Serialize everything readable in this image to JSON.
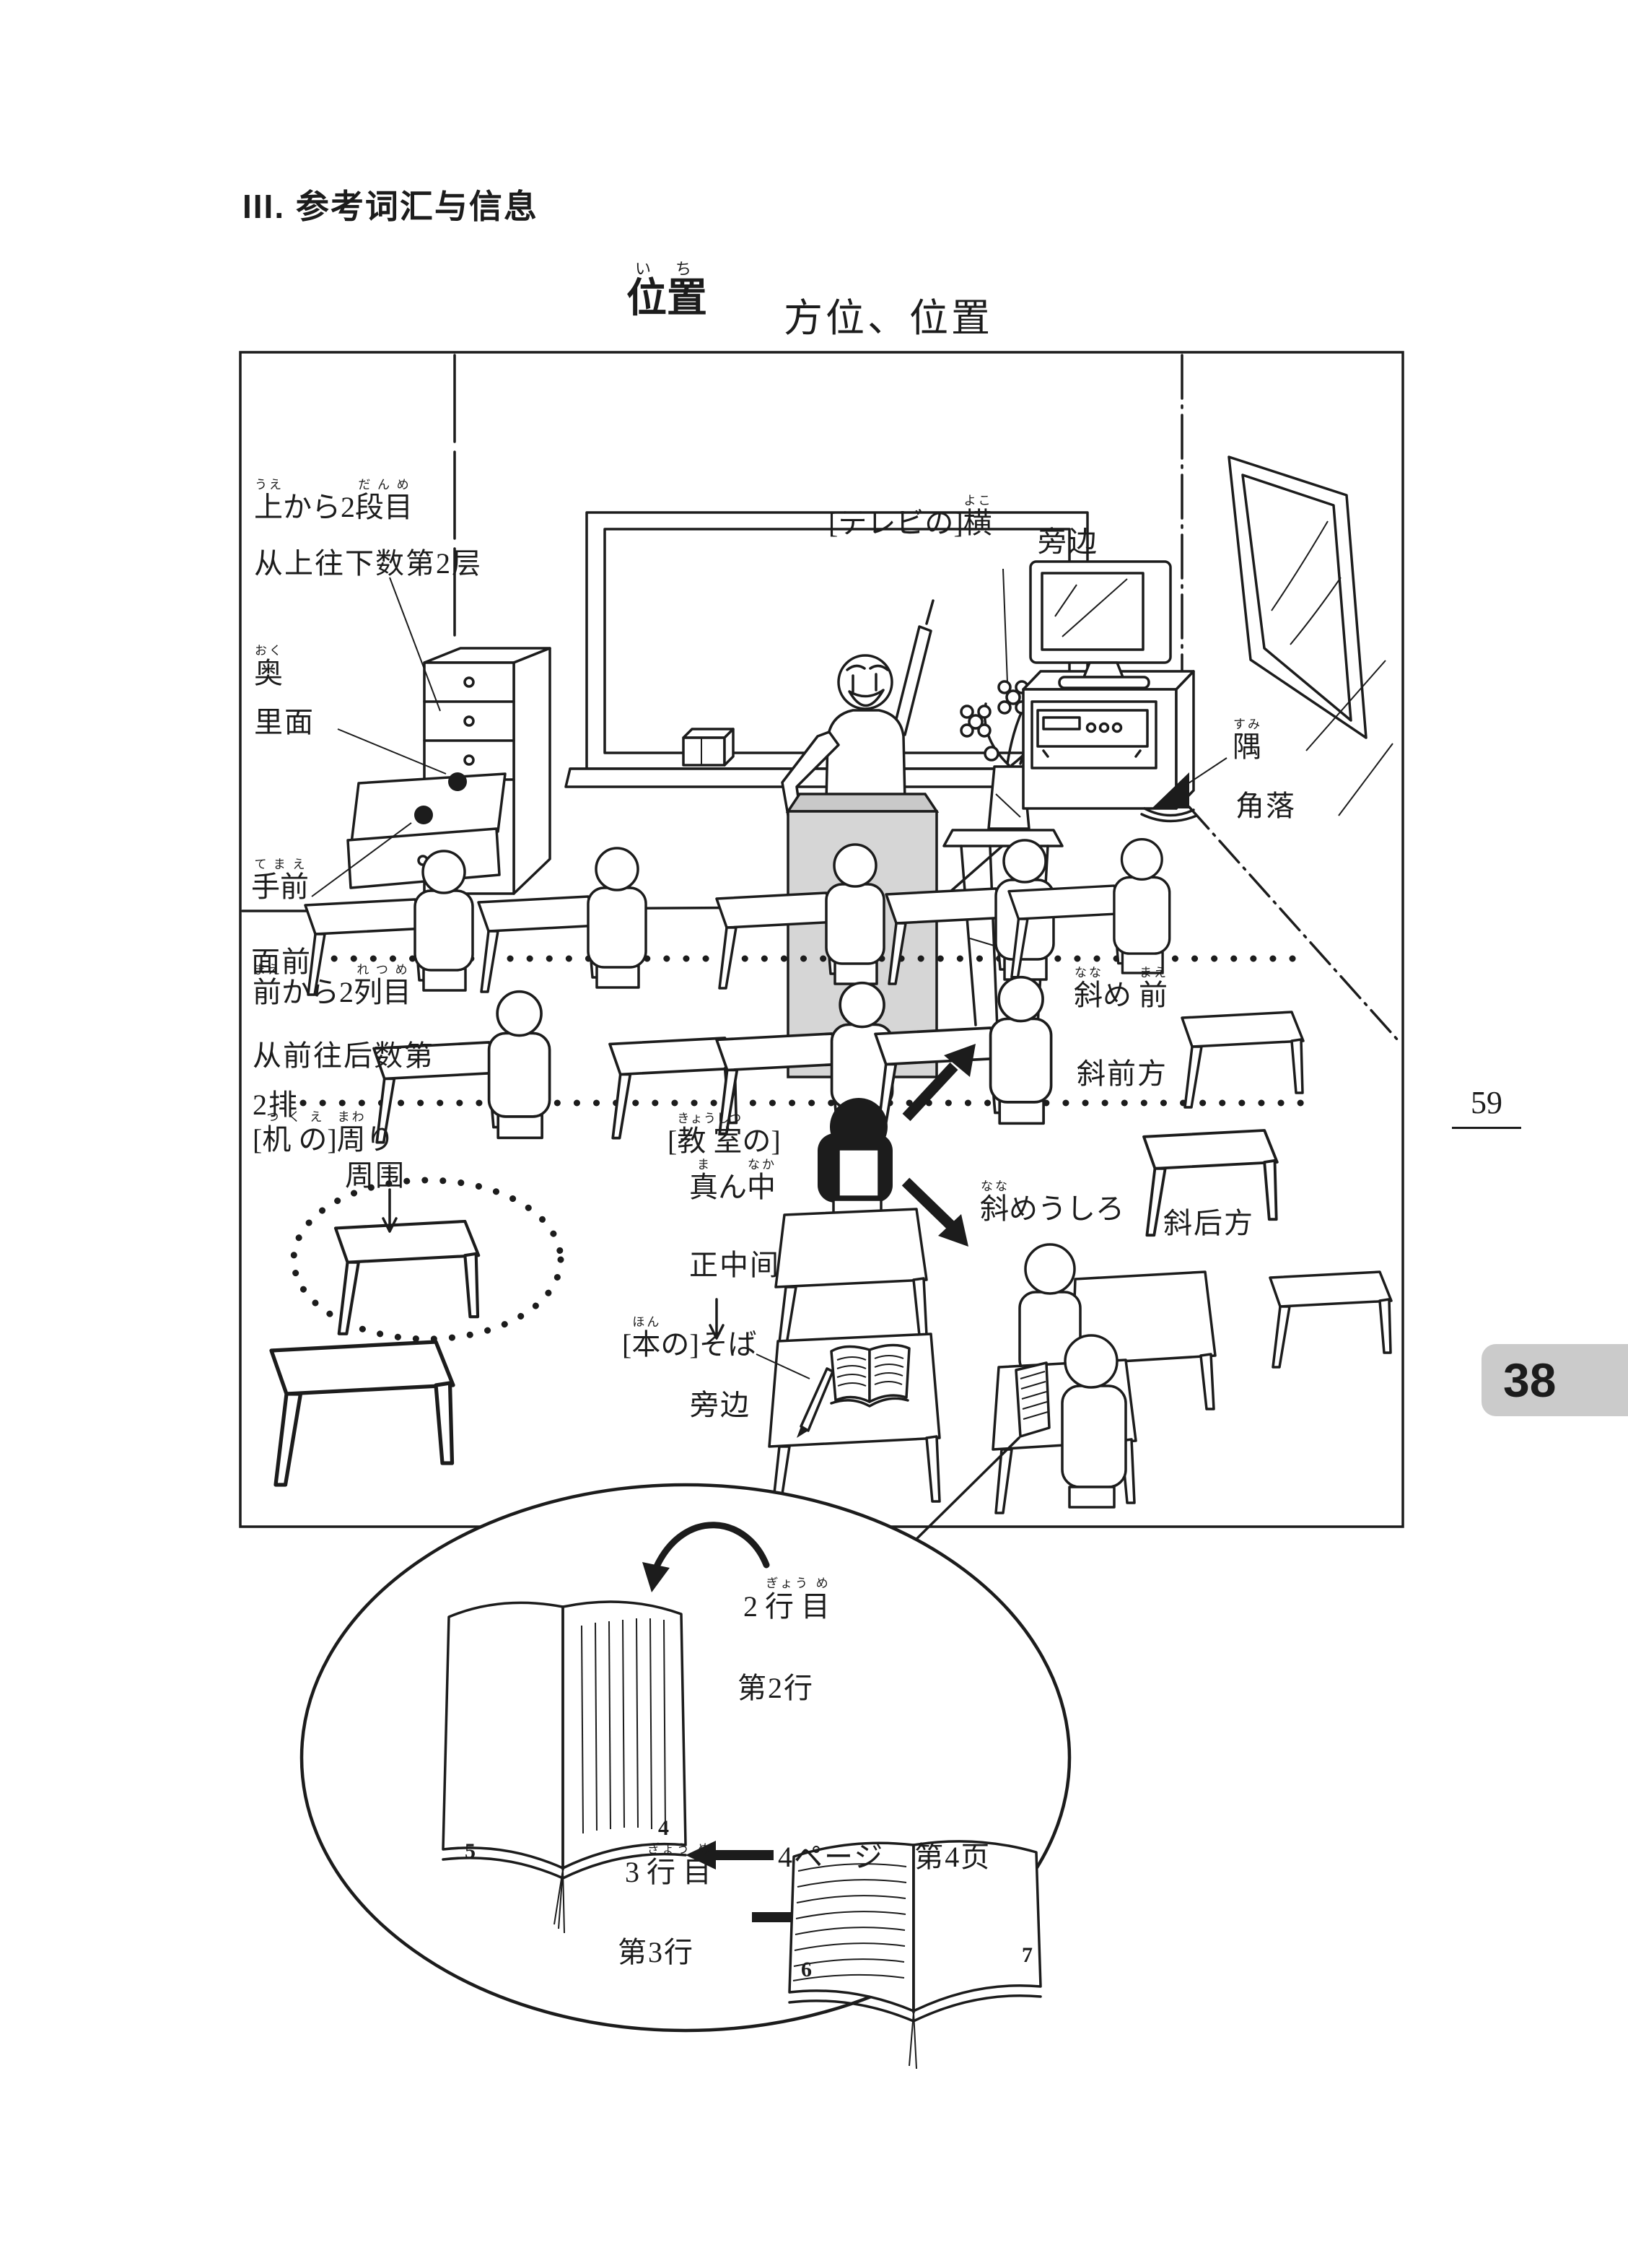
{
  "page": {
    "header": "III. 参考词汇与信息",
    "page_number": "59",
    "lesson_number": "38"
  },
  "title": {
    "ruby": [
      {
        "t": "位",
        "r": "い"
      },
      {
        "t": "置",
        "r": "ち"
      }
    ],
    "sub": "方位、位置"
  },
  "colors": {
    "ink": "#1c1c1c",
    "podium_gray": "#d6d6d6",
    "lesson_box_gray": "#cbcbcb"
  },
  "diagram": {
    "labels": {
      "from_top_2nd": {
        "ja": [
          {
            "t": "上",
            "r": "うえ"
          },
          {
            "t": "から2",
            "r": ""
          },
          {
            "t": "段目",
            "r": "だんめ"
          }
        ],
        "zh": "从上往下数第2层"
      },
      "back_inner": {
        "ja": [
          {
            "t": "奥",
            "r": "おく"
          }
        ],
        "zh": "里面"
      },
      "front_near": {
        "ja": [
          {
            "t": "手前",
            "r": "てまえ"
          }
        ],
        "zh": "面前"
      },
      "beside_tv": {
        "ja": [
          {
            "t": "[テレビの]",
            "r": ""
          },
          {
            "t": "横",
            "r": "よこ"
          }
        ],
        "zh": "旁边"
      },
      "corner": {
        "ja": [
          {
            "t": "隅",
            "r": "すみ"
          }
        ],
        "zh": "角落"
      },
      "second_row": {
        "ja": [
          {
            "t": "前",
            "r": "まえ"
          },
          {
            "t": "から2",
            "r": ""
          },
          {
            "t": "列目",
            "r": "れつめ"
          }
        ],
        "zh_line1": "从前往后数第",
        "zh_line2": "2排"
      },
      "around_desk": {
        "ja": [
          {
            "t": "[",
            "r": ""
          },
          {
            "t": "机 の",
            "r": "つくえ"
          },
          {
            "t": "]",
            "r": ""
          },
          {
            "t": "周",
            "r": "まわ"
          },
          {
            "t": "り",
            "r": ""
          }
        ],
        "zh": "周围"
      },
      "classroom_middle": {
        "ja_line1": [
          {
            "t": "[",
            "r": ""
          },
          {
            "t": "教 室",
            "r": "きょうしつ"
          },
          {
            "t": "の]",
            "r": ""
          }
        ],
        "ja_line2": [
          {
            "t": "真",
            "r": "ま"
          },
          {
            "t": "ん",
            "r": ""
          },
          {
            "t": "中",
            "r": "なか"
          }
        ],
        "zh": "正中间"
      },
      "diagonal_front": {
        "ja": [
          {
            "t": "斜",
            "r": "なな"
          },
          {
            "t": "め ",
            "r": ""
          },
          {
            "t": "前",
            "r": "まえ"
          }
        ],
        "zh": "斜前方"
      },
      "diagonal_behind": {
        "ja": [
          {
            "t": "斜",
            "r": "なな"
          },
          {
            "t": "めうしろ",
            "r": ""
          }
        ],
        "zh": "斜后方"
      },
      "beside_book": {
        "ja": [
          {
            "t": "[",
            "r": ""
          },
          {
            "t": "本",
            "r": "ほん"
          },
          {
            "t": "の]そば",
            "r": ""
          }
        ],
        "zh": "旁边"
      }
    },
    "inset": {
      "line_2": {
        "ja": [
          {
            "t": "2 ",
            "r": ""
          },
          {
            "t": "行 目",
            "r": "ぎょう め"
          }
        ],
        "zh": "第2行"
      },
      "page_4": "4ページ　第4页",
      "line_3": {
        "ja": [
          {
            "t": "3 ",
            "r": ""
          },
          {
            "t": "行 目",
            "r": "ぎょう め"
          }
        ],
        "zh": "第3行"
      },
      "book1_left_page_no": "5",
      "book1_right_page_no": "4",
      "book2_left_page_no": "6",
      "book2_right_page_no": "7"
    }
  }
}
